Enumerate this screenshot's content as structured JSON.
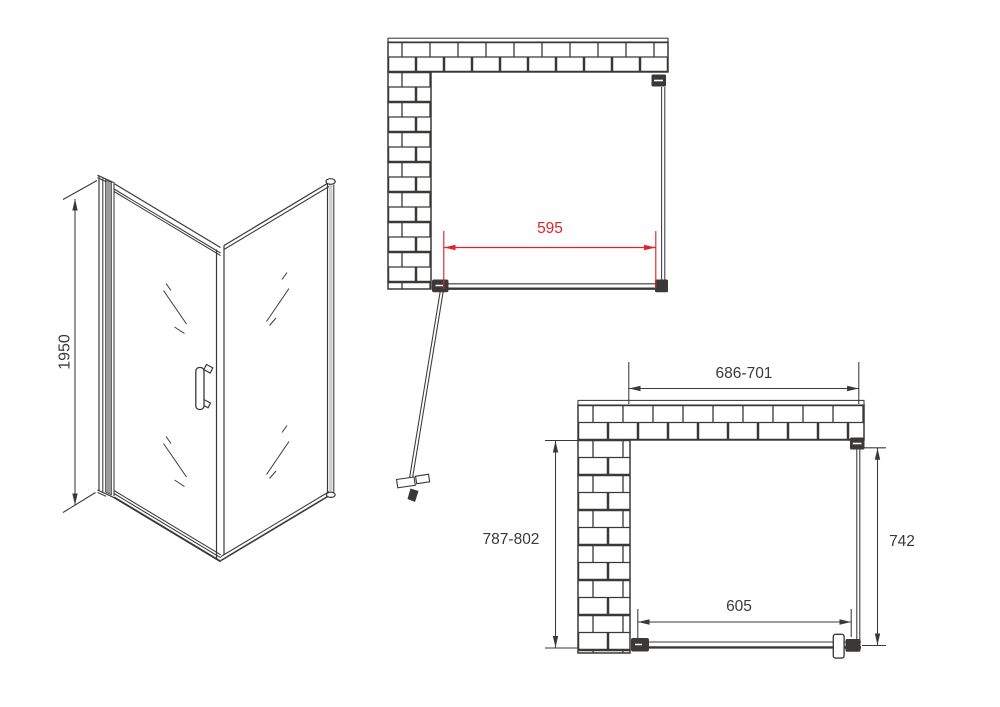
{
  "colors": {
    "line": "#3a3937",
    "dim_red": "#e32228",
    "metal_gray": "#9a9a9a",
    "background": "#ffffff"
  },
  "iso_view": {
    "height_label": "1950"
  },
  "top_view_open": {
    "door_width_label": "595"
  },
  "top_view_plan": {
    "overall_width_label": "686-701",
    "left_depth_label": "787-802",
    "panel_depth_label": "742",
    "door_width_label": "605"
  }
}
